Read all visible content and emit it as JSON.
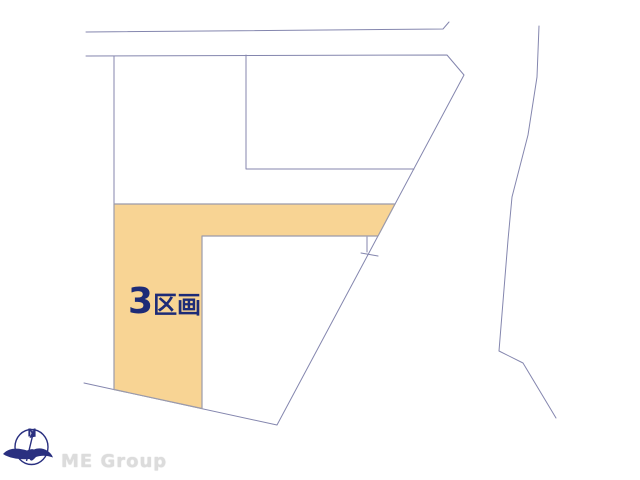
{
  "map": {
    "parcel_label": {
      "number": "3",
      "unit": "区画"
    },
    "compass": {
      "north": "N"
    },
    "brand": "ME Group"
  },
  "colors": {
    "parcel_fill": "#F8D494",
    "parcel_border": "#9B9BAB",
    "boundary_line": "#8486AE",
    "label_text": "#1D2B77",
    "compass_navy": "#2A3080",
    "brand_text": "#DCDCDC"
  }
}
